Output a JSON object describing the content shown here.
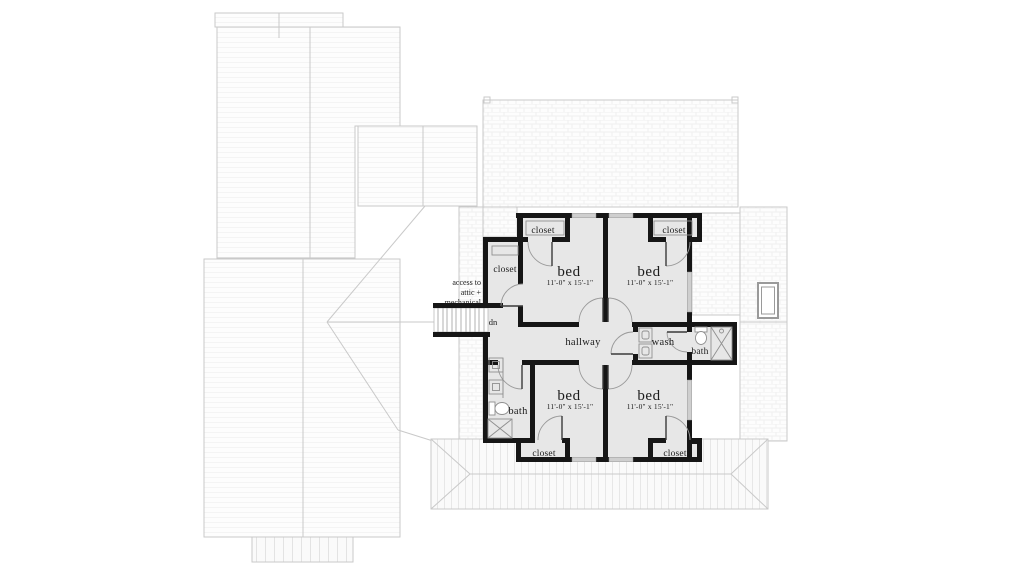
{
  "plan": {
    "bedrooms": [
      {
        "label": "bed",
        "dims": "11'-0\" x 15'-1\""
      },
      {
        "label": "bed",
        "dims": "11'-0\" x 15'-1\""
      },
      {
        "label": "bed",
        "dims": "11'-0\" x 15'-1\""
      },
      {
        "label": "bed",
        "dims": "11'-0\" x 15'-1\""
      }
    ],
    "closet_label": "closet",
    "hallway_label": "hallway",
    "wash_label": "wash",
    "bath_label": "bath",
    "stairs_direction": "dn",
    "attic_note": {
      "line1": "access to",
      "line2": "attic +",
      "line3": "mechanical"
    }
  },
  "colors": {
    "wall": "#161616",
    "room_fill": "#e7e7e7",
    "roof_line": "#c9c9c9",
    "window_sill": "#cfcfcf",
    "text": "#1b1b1b",
    "background": "#ffffff"
  }
}
